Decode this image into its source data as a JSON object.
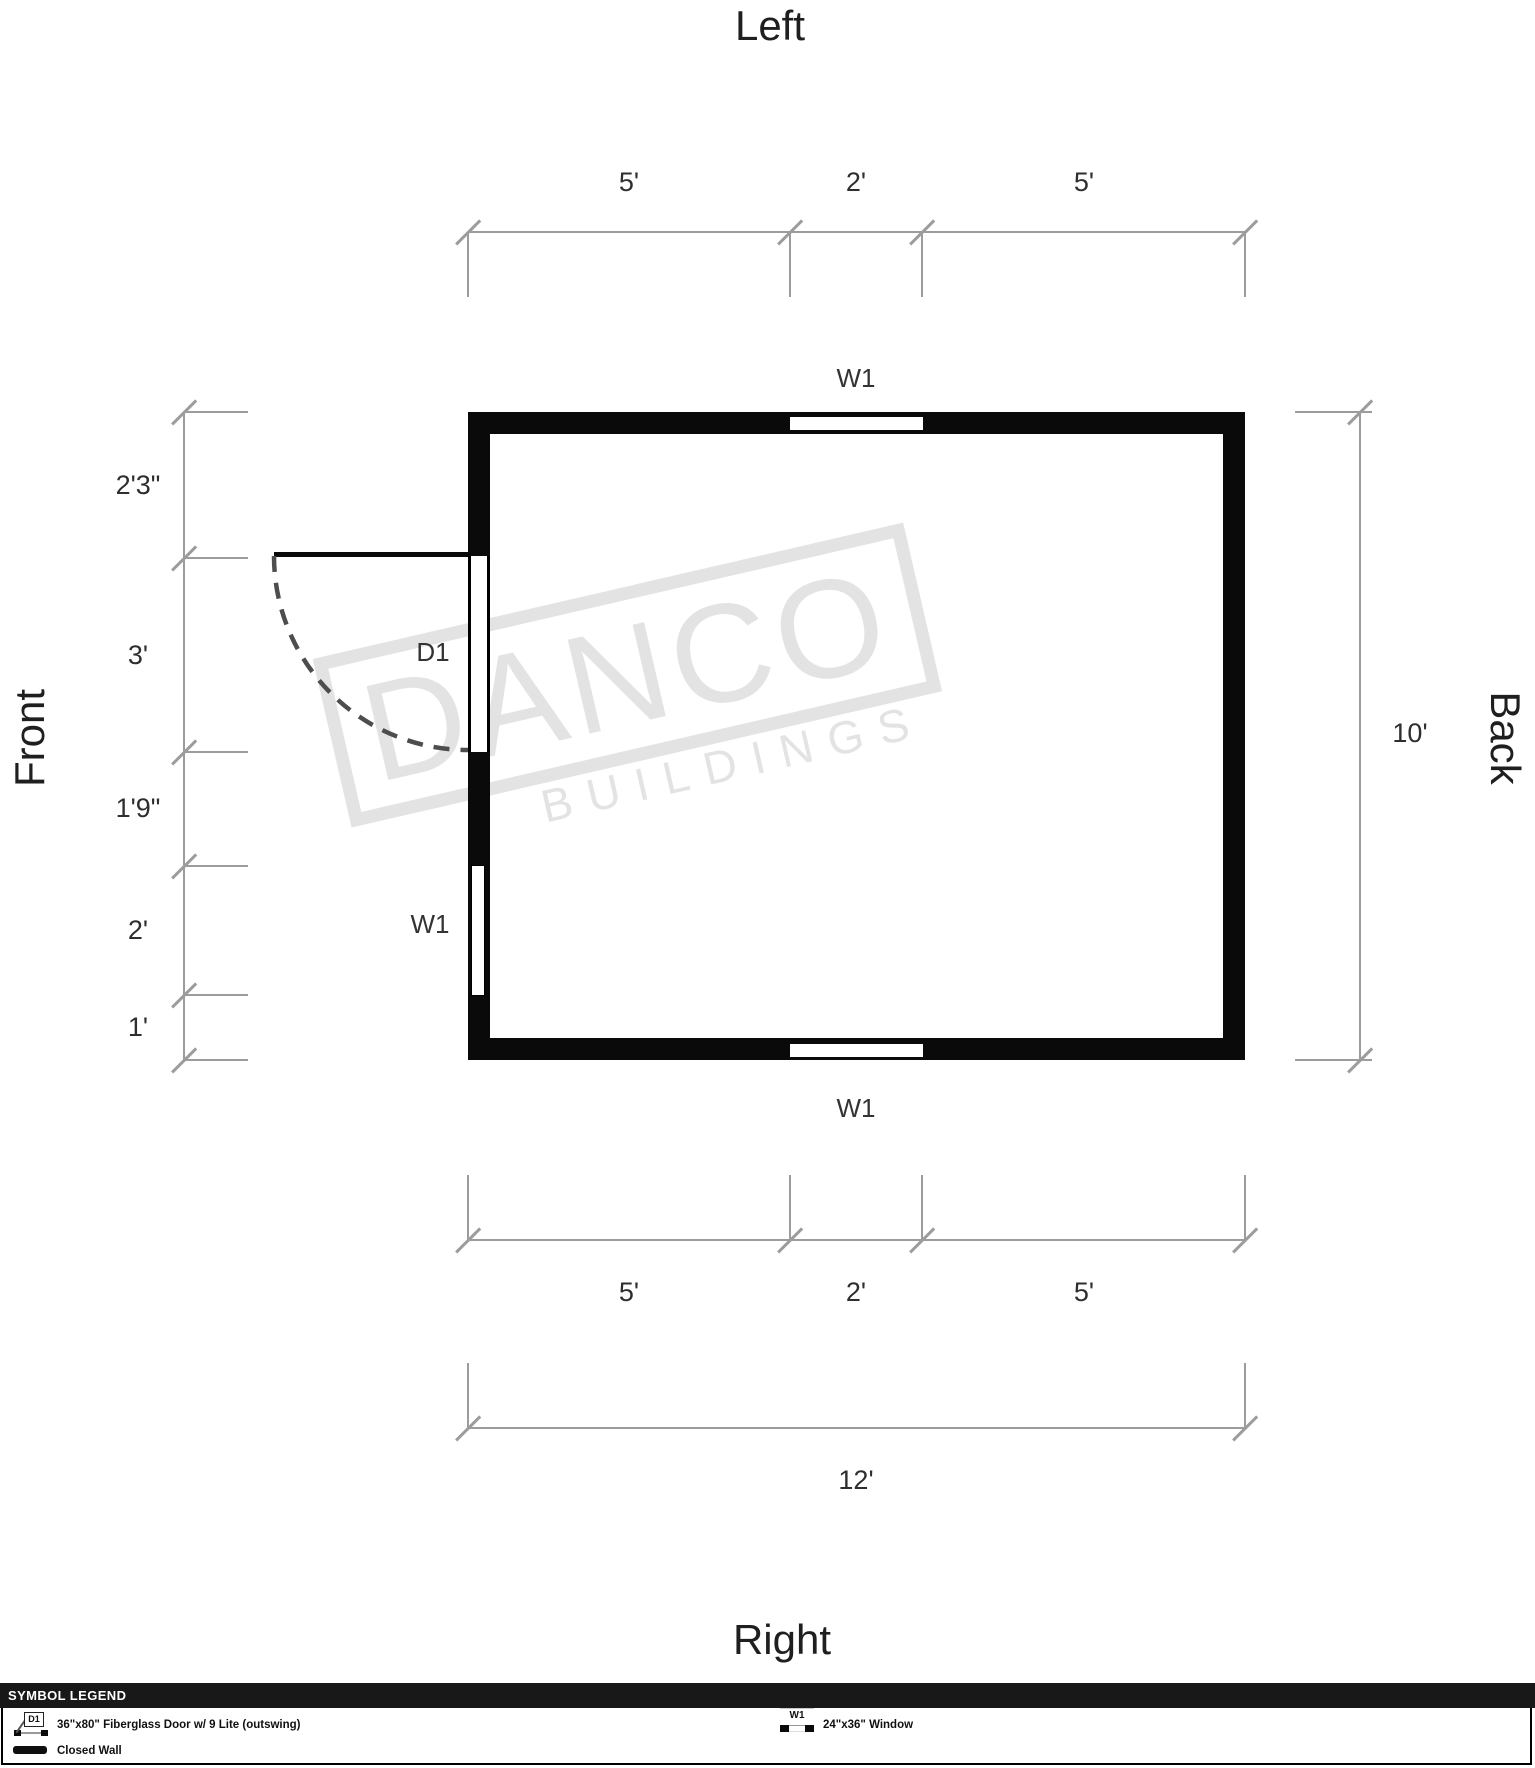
{
  "titles": {
    "top": "Left",
    "bottom": "Right",
    "left_side": "Front",
    "right_side": "Back"
  },
  "plan_labels": {
    "top_window": "W1",
    "bottom_window": "W1",
    "left_window": "W1",
    "door": "D1"
  },
  "dimensions": {
    "top_segments": [
      "5'",
      "2'",
      "5'"
    ],
    "left_segments": [
      "2'3\"",
      "3'",
      "1'9\"",
      "2'",
      "1'"
    ],
    "right_total": "10'",
    "bottom_segments": [
      "5'",
      "2'",
      "5'"
    ],
    "bottom_total": "12'"
  },
  "watermark": {
    "line1": "DANCO",
    "line2": "BUILDINGS"
  },
  "legend": {
    "header": "SYMBOL LEGEND",
    "door": {
      "symbol": "D1",
      "desc": "36\"x80\" Fiberglass Door w/ 9 Lite (outswing)"
    },
    "window": {
      "symbol": "W1",
      "desc": "24\"x36\" Window"
    },
    "wall": {
      "desc": "Closed Wall"
    }
  },
  "colors": {
    "wall": "#0a0a0a",
    "dim_line": "#9c9c9c",
    "watermark": "#e3e3e3",
    "legend_bar": "#181818"
  }
}
